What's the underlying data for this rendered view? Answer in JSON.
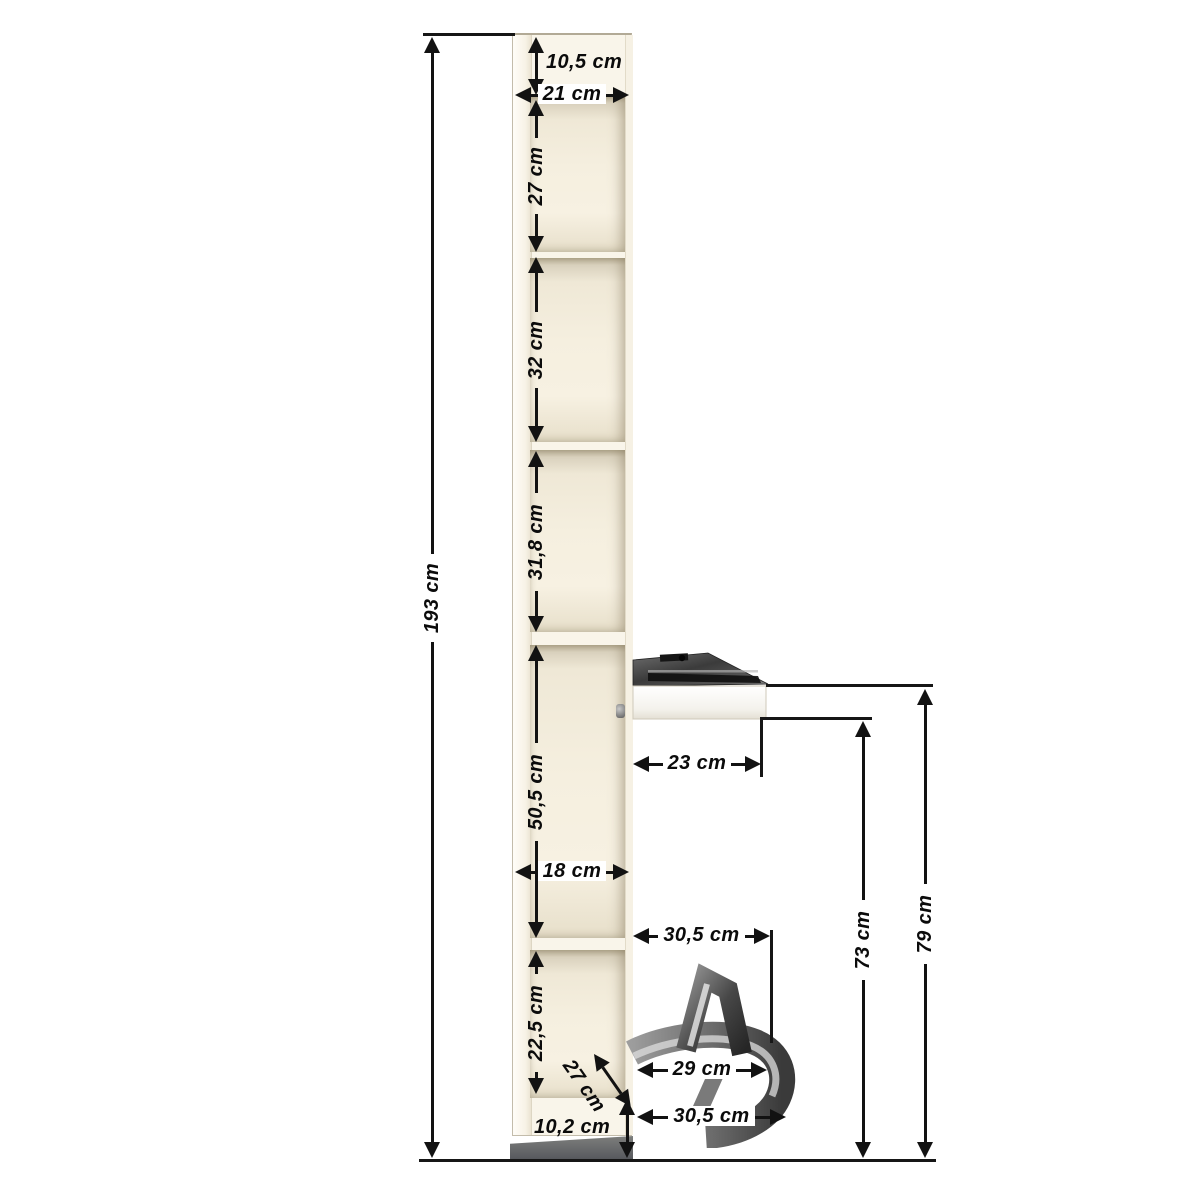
{
  "diagram": {
    "unit": "cm",
    "line_color": "#121212",
    "cabinet_color": "#f6f0e1",
    "plinth_color": "#64666b",
    "labels": {
      "total_height": "193 cm",
      "top_panel_height": "10,5 cm",
      "top_depth": "21 cm",
      "compartment1_height": "27 cm",
      "compartment2_height": "32 cm",
      "compartment3_height": "31,8 cm",
      "shelf_depth": "23 cm",
      "compartment4_height": "50,5 cm",
      "middle_depth": "18 cm",
      "holder_upper_depth": "30,5 cm",
      "shelf_underside_height": "73 cm",
      "shelf_top_height": "79 cm",
      "compartment5_height": "22,5 cm",
      "iron_rest_diagonal": "27 cm",
      "iron_rest_width": "29 cm",
      "iron_rest_outer_depth": "30,5 cm",
      "plinth_height": "10,2 cm"
    }
  }
}
